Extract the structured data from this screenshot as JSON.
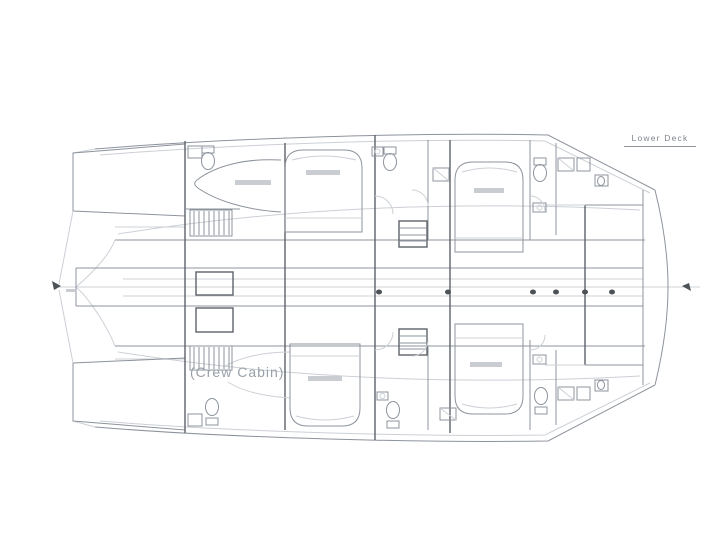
{
  "page": {
    "background": "#ffffff"
  },
  "drawing": {
    "title": "Lower Deck",
    "crew_cabin_label": "(Crew Cabin)",
    "type": "catamaran-lower-deck-floor-plan",
    "colors": {
      "line": "#8d939c",
      "line_dark": "#5d6269",
      "line_faint": "#ccd0d6",
      "text": "#81868e"
    }
  }
}
